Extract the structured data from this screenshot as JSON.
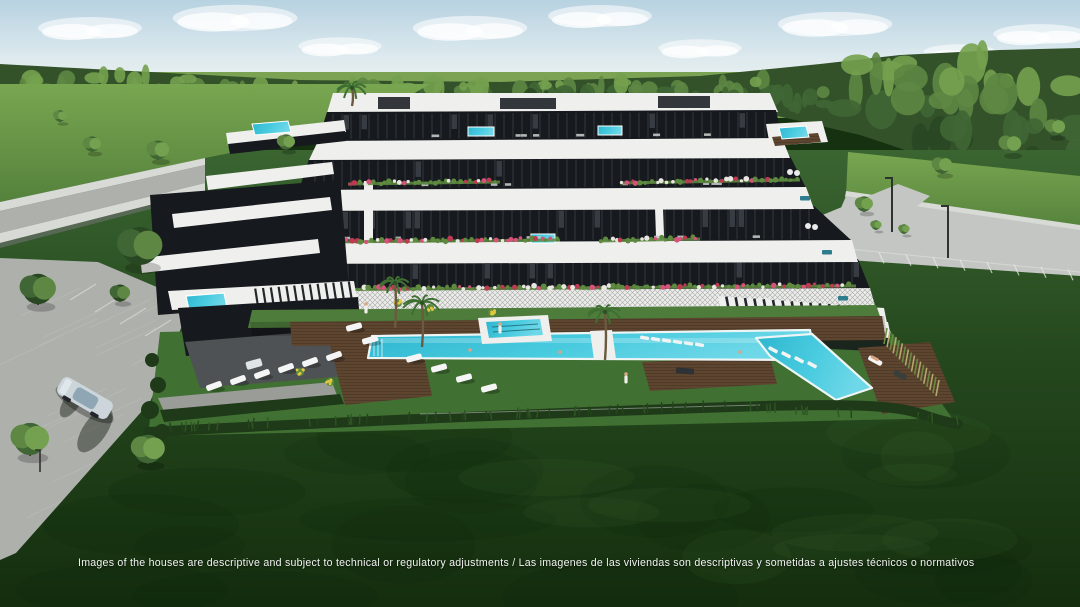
{
  "scene": {
    "kind": "3d-architectural-render",
    "subject": "modern-apartment-complex-with-pools-and-gardens"
  },
  "disclaimer": {
    "text": "Images of the houses are descriptive and subject to technical or regulatory adjustments / Las imagenes de las viviendas son descriptivas y sometidas a ajustes técnicos o normativos"
  },
  "palette": {
    "sky_top": "#b7d2e1",
    "sky_mid": "#dcE9ee",
    "sky_horizon": "#eef3f0",
    "cloud": "#ffffff",
    "far_field": "#7ca254",
    "forest_base": "#33522a",
    "forest_dark": "#2a4723",
    "forest_mid": "#3f6634",
    "forest_light": "#5d8742",
    "forest_hi": "#74a14f",
    "field_top": "#78a650",
    "field_bot": "#55823c",
    "lawn_top": "#3a6531",
    "lawn_mid": "#25481e",
    "lawn_deep": "#142e0e",
    "lawn_resort": "#417033",
    "garden": "#4e7c3b",
    "road_light": "#c3c6c2",
    "road_mid": "#aeb0ac",
    "road_dark": "#8d908c",
    "sidewalk": "#d8dad6",
    "gravel": "#9a9c98",
    "paving": "#4f5254",
    "building_white": "#efefed",
    "building_shadow": "#d6d7d5",
    "glazing": "#16191d",
    "glazing_light": "#525a60",
    "mullion": "#3c4246",
    "pool_deep": "#2db6cf",
    "pool_light": "#6fd8e8",
    "deck": "#5d4530",
    "deck_line": "#4a3525",
    "hedge": "#1e3a18",
    "tuft1": "#24441c",
    "tuft2": "#2f5524",
    "flower_pink": "#d6527a",
    "flower_red": "#bd3a52",
    "flower_white": "#e9e6e1",
    "flower_yellow": "#e3c93f",
    "leaf": "#5d8a3e",
    "trunk": "#4b3b2a",
    "palm": "#3f6f33",
    "teal_sofa": "#2e7d8f",
    "car_body": "#ccd6da",
    "car_glass": "#8fa7b4",
    "lamp": "#2f332f",
    "skin": "#d9a583",
    "grass_tall1": "#b3a96a",
    "grass_tall2": "#6d8a45"
  }
}
